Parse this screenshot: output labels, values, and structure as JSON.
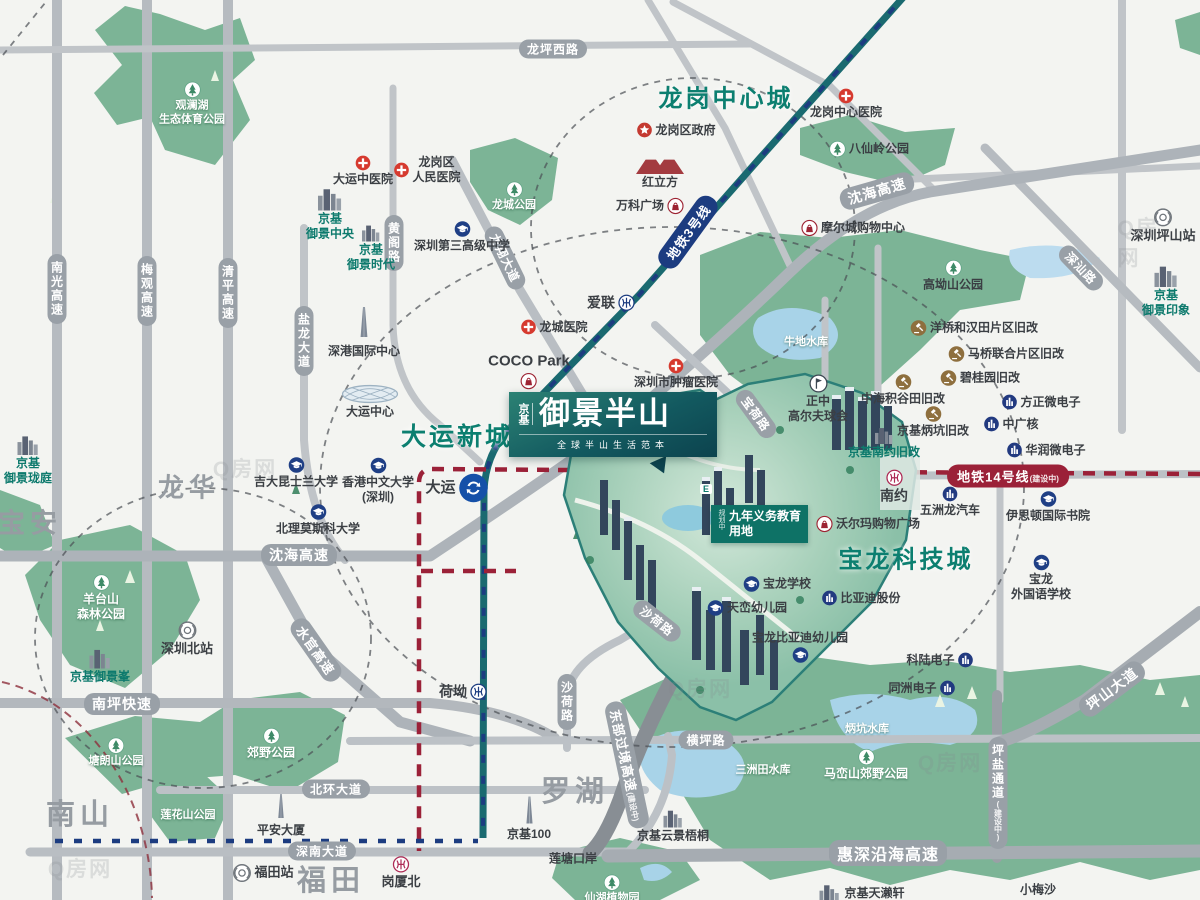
{
  "palette": {
    "teal": "#0d7a6d",
    "navy": "#1c3c80",
    "crimson": "#9b2138",
    "magenta": "#ad2a55",
    "road": "#99a0a7",
    "dark": "#3b3f44",
    "white": "#ffffff",
    "gray": "#969ca2",
    "park": "#79b294",
    "water": "#a8d3e8",
    "brand": "#135a60"
  },
  "logo": {
    "brand": "京基",
    "title": "御景半山",
    "tagline": "全球半山生活范本"
  },
  "edu": {
    "tag": "规划中",
    "l1": "九年义务教育",
    "l2": "用地"
  },
  "render_mark": "E",
  "areas": [
    {
      "t": "龙岗中心城",
      "x": 726,
      "y": 96,
      "fs": 24
    },
    {
      "t": "大运新城",
      "x": 457,
      "y": 435,
      "fs": 25
    },
    {
      "t": "宝龙科技城",
      "x": 906,
      "y": 557,
      "fs": 24
    }
  ],
  "districts": [
    {
      "t": "宝安",
      "x": 30,
      "y": 521,
      "fs": 27
    },
    {
      "t": "龙华",
      "x": 189,
      "y": 486,
      "fs": 26
    },
    {
      "t": "南山",
      "x": 80,
      "y": 812,
      "fs": 29
    },
    {
      "t": "福田",
      "x": 331,
      "y": 878,
      "fs": 29
    },
    {
      "t": "罗湖",
      "x": 575,
      "y": 789,
      "fs": 29
    }
  ],
  "metro_pills": [
    {
      "t": "地铁3号线",
      "x": 688,
      "y": 232,
      "rot": -54,
      "bg": "navy"
    },
    {
      "t": "地铁14号线",
      "tag": "(建设中)",
      "x": 1008,
      "y": 476,
      "rot": 0,
      "bg": "crimson"
    }
  ],
  "road_labels": [
    {
      "t": "南光高速",
      "x": 57,
      "y": 289,
      "v": 1
    },
    {
      "t": "梅观高速",
      "x": 147,
      "y": 291,
      "v": 1
    },
    {
      "t": "清平高速",
      "x": 228,
      "y": 293,
      "v": 1
    },
    {
      "t": "盐龙大道",
      "x": 304,
      "y": 341,
      "v": 1
    },
    {
      "t": "黄阁路",
      "x": 394,
      "y": 243,
      "v": 1
    },
    {
      "t": "龙坪西路",
      "x": 553,
      "y": 49
    },
    {
      "t": "沈海高速",
      "x": 877,
      "y": 191,
      "rot": -16,
      "fs": 14
    },
    {
      "t": "沈海高速",
      "x": 299,
      "y": 555,
      "fs": 14
    },
    {
      "t": "龙翔大道",
      "x": 505,
      "y": 258,
      "rot": 64
    },
    {
      "t": "宝荷路",
      "x": 756,
      "y": 414,
      "rot": 54
    },
    {
      "t": "沙荷路",
      "x": 657,
      "y": 621,
      "rot": 38
    },
    {
      "t": "沙荷路",
      "x": 567,
      "y": 702,
      "v": 1
    },
    {
      "t": "水官高速",
      "x": 316,
      "y": 650,
      "rot": 55,
      "fs": 13
    },
    {
      "t": "南坪快速",
      "x": 122,
      "y": 704,
      "fs": 14
    },
    {
      "t": "北环大道",
      "x": 336,
      "y": 789
    },
    {
      "t": "深南大道",
      "x": 322,
      "y": 851
    },
    {
      "t": "横坪路",
      "x": 706,
      "y": 740
    },
    {
      "t": "惠深沿海高速",
      "x": 888,
      "y": 853,
      "fs": 16
    },
    {
      "t": "东部过境高速",
      "x": 627,
      "y": 765,
      "rot": 78,
      "fs": 13,
      "tag": "(建设中)"
    },
    {
      "t": "坪山大道",
      "x": 1112,
      "y": 689,
      "rot": -37,
      "fs": 14
    },
    {
      "t": "坪盐通道",
      "x": 998,
      "y": 793,
      "v": 1,
      "tag": "(建设中)"
    },
    {
      "t": "深汕路",
      "x": 1081,
      "y": 268,
      "rot": 46
    }
  ],
  "pois": [
    {
      "n": "dayun-tcm-hospital",
      "t": "大运中医院",
      "x": 363,
      "y": 171,
      "i": "cross",
      "ip": "col"
    },
    {
      "n": "longgang-people-hospital",
      "t": "龙岗区|人民医院",
      "x": 427,
      "y": 170,
      "i": "cross",
      "ip": "row"
    },
    {
      "n": "longgang-government",
      "t": "龙岗区政府",
      "x": 676,
      "y": 130,
      "i": "star",
      "ip": "row"
    },
    {
      "n": "longgang-central-hospital",
      "t": "龙岗中心医院",
      "x": 846,
      "y": 104,
      "i": "cross",
      "ip": "col"
    },
    {
      "n": "longcheng-hospital",
      "t": "龙城医院",
      "x": 554,
      "y": 327,
      "i": "cross",
      "ip": "row"
    },
    {
      "n": "cancer-hospital",
      "t": "深圳市肿瘤医院",
      "x": 676,
      "y": 374,
      "i": "cross",
      "ip": "col"
    },
    {
      "n": "moercheng-mall",
      "t": "摩尔城购物中心",
      "x": 853,
      "y": 228,
      "i": "bag",
      "ip": "row"
    },
    {
      "n": "vanke-plaza",
      "t": "万科广场",
      "x": 650,
      "y": 206,
      "i": "bag",
      "ip": "rowr"
    },
    {
      "n": "coco-park",
      "t": "COCO Park",
      "x": 529,
      "y": 371,
      "i": "bag",
      "ip": "colr",
      "fs": 15
    },
    {
      "n": "honglifang",
      "t": "红立方",
      "x": 660,
      "y": 174,
      "i": "redcube",
      "ip": "col",
      "iw": 54,
      "ih": 16
    },
    {
      "n": "walmart-plaza",
      "t": "沃尔玛购物广场",
      "x": 868,
      "y": 524,
      "i": "bag",
      "ip": "row"
    },
    {
      "n": "ailian-station",
      "t": "爱联",
      "x": 611,
      "y": 303,
      "i": "mN",
      "ip": "rowr",
      "fs": 14
    },
    {
      "n": "heao-station",
      "t": "荷坳",
      "x": 463,
      "y": 692,
      "i": "mN",
      "ip": "rowr",
      "fs": 14
    },
    {
      "n": "nanyue-station",
      "t": "南约",
      "x": 894,
      "y": 487,
      "i": "mM",
      "ip": "col",
      "fs": 14
    },
    {
      "n": "gangxiabei-station",
      "t": "岗厦北",
      "x": 401,
      "y": 873,
      "i": "mM",
      "ip": "col",
      "fs": 13
    },
    {
      "n": "dayun-station",
      "t": "大运",
      "x": 457,
      "y": 488,
      "i": "du",
      "ip": "rowr",
      "fs": 15,
      "iw": 30,
      "ih": 30
    },
    {
      "n": "futian-station",
      "t": "福田站",
      "x": 263,
      "y": 873,
      "i": "rail",
      "ip": "row",
      "fs": 13
    },
    {
      "n": "shenzhenbei-station",
      "t": "深圳北站",
      "x": 187,
      "y": 639,
      "i": "rail",
      "ip": "col",
      "fs": 13
    },
    {
      "n": "pingshan-station",
      "t": "深圳坪山站",
      "x": 1163,
      "y": 226,
      "i": "rail",
      "ip": "col",
      "fs": 13
    },
    {
      "n": "no3-high-school",
      "t": "深圳第三高级中学",
      "x": 462,
      "y": 237,
      "i": "cap",
      "ip": "col"
    },
    {
      "n": "jida-queensland-univ",
      "t": "吉大昆士兰大学",
      "x": 296,
      "y": 473,
      "i": "cap",
      "ip": "col"
    },
    {
      "n": "cuhk-shenzhen",
      "t": "香港中文大学|(深圳)",
      "x": 378,
      "y": 481,
      "i": "cap",
      "ip": "col"
    },
    {
      "n": "moscow-univ",
      "t": "北理莫斯科大学",
      "x": 318,
      "y": 520,
      "i": "cap",
      "ip": "col"
    },
    {
      "n": "easton-college",
      "t": "伊思顿国际书院",
      "x": 1048,
      "y": 507,
      "i": "cap",
      "ip": "col"
    },
    {
      "n": "baolong-foreign-school",
      "t": "宝龙|外国语学校",
      "x": 1041,
      "y": 578,
      "i": "cap",
      "ip": "col"
    },
    {
      "n": "baolong-school",
      "t": "宝龙学校",
      "x": 777,
      "y": 584,
      "i": "cap",
      "ip": "row"
    },
    {
      "n": "tianluan-kindergarten",
      "t": "天峦幼儿园",
      "x": 747,
      "y": 608,
      "i": "cap",
      "ip": "row"
    },
    {
      "n": "byd-kindergarten",
      "t": "宝龙比亚迪幼儿园",
      "x": 800,
      "y": 647,
      "i": "cap",
      "ip": "colr"
    },
    {
      "n": "founder-micro",
      "t": "方正微电子",
      "x": 1041,
      "y": 402,
      "i": "bldg",
      "ip": "row"
    },
    {
      "n": "cgn",
      "t": "中广核",
      "x": 1011,
      "y": 424,
      "i": "bldg",
      "ip": "row"
    },
    {
      "n": "crmicro",
      "t": "华润微电子",
      "x": 1046,
      "y": 450,
      "i": "bldg",
      "ip": "row"
    },
    {
      "n": "wuzhoulong-auto",
      "t": "五洲龙汽车",
      "x": 950,
      "y": 502,
      "i": "bldg",
      "ip": "col"
    },
    {
      "n": "byd-co",
      "t": "比亚迪股份",
      "x": 861,
      "y": 598,
      "i": "bldg",
      "ip": "row"
    },
    {
      "n": "kelu-electronics",
      "t": "科陆电子",
      "x": 940,
      "y": 660,
      "i": "bldg",
      "ip": "rowr"
    },
    {
      "n": "tongzhou-electronics",
      "t": "同洲电子",
      "x": 922,
      "y": 688,
      "i": "bldg",
      "ip": "rowr"
    },
    {
      "n": "yangqiao-redev",
      "t": "洋桥和汉田片区旧改",
      "x": 974,
      "y": 328,
      "i": "gavel",
      "ip": "row"
    },
    {
      "n": "maqiao-redev",
      "t": "马桥联合片区旧改",
      "x": 1006,
      "y": 354,
      "i": "gavel",
      "ip": "row"
    },
    {
      "n": "biguiyuan-redev",
      "t": "碧桂园旧改",
      "x": 980,
      "y": 378,
      "i": "gavel",
      "ip": "row"
    },
    {
      "n": "zhonghai-redev",
      "t": "中海积谷田旧改",
      "x": 903,
      "y": 390,
      "i": "gavel",
      "ip": "col"
    },
    {
      "n": "jingji-bingkeng-redev",
      "t": "京基炳坑旧改",
      "x": 933,
      "y": 422,
      "i": "gavel",
      "ip": "col"
    },
    {
      "n": "jingji-nanyue-redev",
      "t": "京基南约旧改",
      "x": 884,
      "y": 443,
      "i": "city",
      "ip": "col",
      "c": "teal",
      "iw": 22,
      "ih": 18
    },
    {
      "n": "jingji-yujing-central",
      "t": "京基|御景中央",
      "x": 330,
      "y": 214,
      "i": "city",
      "ip": "col",
      "c": "teal",
      "iw": 30,
      "ih": 24
    },
    {
      "n": "jingji-yujing-era",
      "t": "京基|御景时代",
      "x": 371,
      "y": 248,
      "i": "city",
      "ip": "col",
      "c": "teal",
      "iw": 22,
      "ih": 18
    },
    {
      "n": "shengang-intl-center",
      "t": "深港国际中心",
      "x": 364,
      "y": 330,
      "i": "spire",
      "ip": "col",
      "iw": 10,
      "ih": 42
    },
    {
      "n": "dayun-center",
      "t": "大运中心",
      "x": 370,
      "y": 402,
      "i": "dome",
      "ip": "col",
      "iw": 58,
      "ih": 19
    },
    {
      "n": "jingji-yujing-longting",
      "t": "京基|御景珑庭",
      "x": 28,
      "y": 460,
      "i": "city",
      "ip": "col",
      "c": "teal",
      "iw": 26,
      "ih": 21
    },
    {
      "n": "jingji-yujingfeng",
      "t": "京基御景峯",
      "x": 100,
      "y": 666,
      "i": "city",
      "ip": "col",
      "c": "teal",
      "iw": 26,
      "ih": 21
    },
    {
      "n": "kingkey100",
      "t": "京基100",
      "x": 529,
      "y": 818,
      "i": "spire",
      "ip": "col",
      "iw": 9,
      "ih": 32
    },
    {
      "n": "pingan-tower",
      "t": "平安大厦",
      "x": 281,
      "y": 814,
      "i": "spire",
      "ip": "col",
      "iw": 8,
      "ih": 32
    },
    {
      "n": "jingji-yunjing-wutong",
      "t": "京基云景梧桐",
      "x": 673,
      "y": 826,
      "i": "city",
      "ip": "col",
      "iw": 24,
      "ih": 19
    },
    {
      "n": "jingji-tianlaixuan",
      "t": "京基天濑轩",
      "x": 861,
      "y": 893,
      "i": "city",
      "ip": "row",
      "iw": 24,
      "ih": 20
    },
    {
      "n": "jingji-yujing-impression",
      "t": "京基|御景印象",
      "x": 1166,
      "y": 291,
      "i": "city",
      "ip": "col",
      "c": "teal",
      "iw": 28,
      "ih": 23
    },
    {
      "n": "guanlanhu-park",
      "t": "观澜湖|生态体育公园",
      "x": 192,
      "y": 104,
      "i": "tree",
      "ip": "col",
      "c": "white",
      "fs": 11
    },
    {
      "n": "longcheng-park",
      "t": "龙城公园",
      "x": 514,
      "y": 197,
      "i": "tree",
      "ip": "col",
      "c": "white",
      "fs": 11
    },
    {
      "n": "baxianling-park",
      "t": "八仙岭公园",
      "x": 869,
      "y": 149,
      "i": "tree",
      "ip": "row"
    },
    {
      "n": "gaoaoshan-park",
      "t": "高坳山公园",
      "x": 953,
      "y": 276,
      "i": "tree",
      "ip": "col"
    },
    {
      "n": "yangtaishan-park",
      "t": "羊台山|森林公园",
      "x": 101,
      "y": 598,
      "i": "tree",
      "ip": "col",
      "c": "white"
    },
    {
      "n": "tanglangshan-park",
      "t": "塘朗山公园",
      "x": 116,
      "y": 753,
      "i": "tree",
      "ip": "col",
      "c": "white",
      "fs": 11
    },
    {
      "n": "jiaoye-park",
      "t": "郊野公园",
      "x": 271,
      "y": 744,
      "i": "tree",
      "ip": "col",
      "c": "white"
    },
    {
      "n": "lianhuashan-park",
      "t": "莲花山公园",
      "x": 188,
      "y": 816,
      "c": "white",
      "fs": 11
    },
    {
      "n": "maluanshan-park",
      "t": "马峦山郊野公园",
      "x": 866,
      "y": 765,
      "i": "tree",
      "ip": "col",
      "c": "white"
    },
    {
      "n": "xianhu-garden",
      "t": "仙湖植物园",
      "x": 612,
      "y": 890,
      "i": "tree",
      "ip": "col",
      "c": "white",
      "fs": 11
    },
    {
      "n": "zhengzhong-golf",
      "t": "正中|高尔夫球会",
      "x": 818,
      "y": 399,
      "i": "golf",
      "ip": "col"
    },
    {
      "n": "niudi-reservoir",
      "t": "牛地水库",
      "x": 806,
      "y": 343,
      "c": "white",
      "fs": 11
    },
    {
      "n": "bingkeng-reservoir",
      "t": "炳坑水库",
      "x": 867,
      "y": 730,
      "c": "white",
      "fs": 11
    },
    {
      "n": "sanzhoutian-reservoir",
      "t": "三洲田水库",
      "x": 763,
      "y": 771,
      "c": "white",
      "fs": 11
    },
    {
      "n": "liantang-port",
      "t": "莲塘口岸",
      "x": 573,
      "y": 859,
      "fs": 12
    },
    {
      "n": "xiaomeisha",
      "t": "小梅沙",
      "x": 1038,
      "y": 890,
      "fs": 12
    }
  ],
  "watermarks": [
    {
      "t": "Q房网",
      "x": 245,
      "y": 468
    },
    {
      "t": "Q房网",
      "x": 700,
      "y": 688
    },
    {
      "t": "Q房网",
      "x": 1145,
      "y": 242
    },
    {
      "t": "Q房网",
      "x": 950,
      "y": 762
    },
    {
      "t": "Q房网",
      "x": 80,
      "y": 868
    }
  ],
  "icons": {
    "cross": {
      "s": "s-cross",
      "w": 16,
      "h": 16
    },
    "star": {
      "s": "s-star",
      "w": 16,
      "h": 16
    },
    "bag": {
      "s": "s-bag",
      "w": 17,
      "h": 17
    },
    "tree": {
      "s": "s-tree",
      "w": 17,
      "h": 17
    },
    "cap": {
      "s": "s-cap",
      "w": 17,
      "h": 17
    },
    "bldg": {
      "s": "s-bldg",
      "w": 16,
      "h": 16
    },
    "gavel": {
      "s": "s-gavel",
      "w": 17,
      "h": 17
    },
    "mN": {
      "s": "s-mN",
      "w": 17,
      "h": 17
    },
    "mM": {
      "s": "s-mM",
      "w": 17,
      "h": 17
    },
    "rail": {
      "s": "s-rail",
      "w": 19,
      "h": 19
    },
    "du": {
      "s": "s-du",
      "w": 30,
      "h": 30
    },
    "golf": {
      "s": "s-golf",
      "w": 19,
      "h": 19
    },
    "city": {
      "s": "s-city",
      "w": 26,
      "h": 22
    },
    "spire": {
      "s": "s-spire",
      "w": 9,
      "h": 30
    },
    "dome": {
      "s": "s-dome",
      "w": 56,
      "h": 18
    },
    "redcube": {
      "s": "s-redcube",
      "w": 54,
      "h": 16
    }
  }
}
